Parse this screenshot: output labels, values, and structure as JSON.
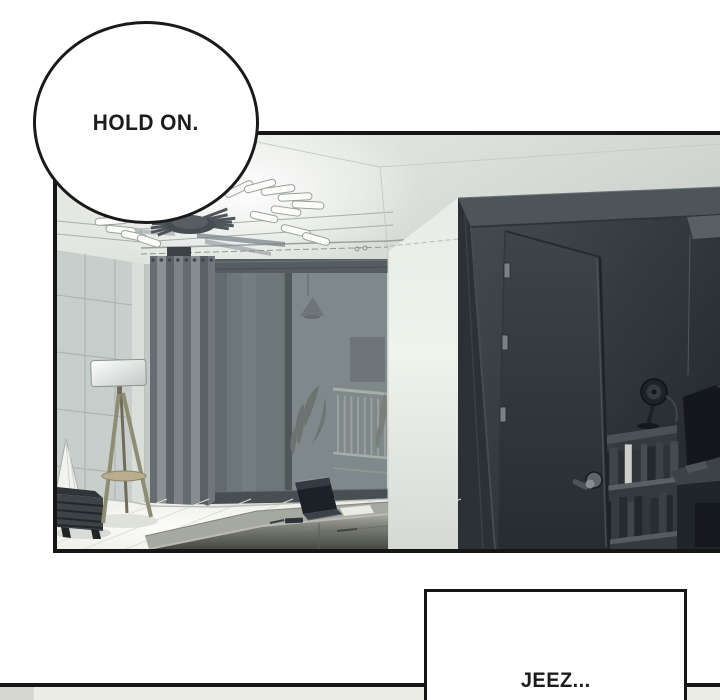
{
  "palette": {
    "ink": "#161616",
    "paper": "#ffffff",
    "panel_tint": "#dfe2dd",
    "dark_room": "#23282d",
    "curtain": "#757c7f",
    "next_panel_strip": "#ecede7"
  },
  "speech": {
    "hold_on": "HOLD ON.",
    "jeez": "JEEZ..."
  }
}
